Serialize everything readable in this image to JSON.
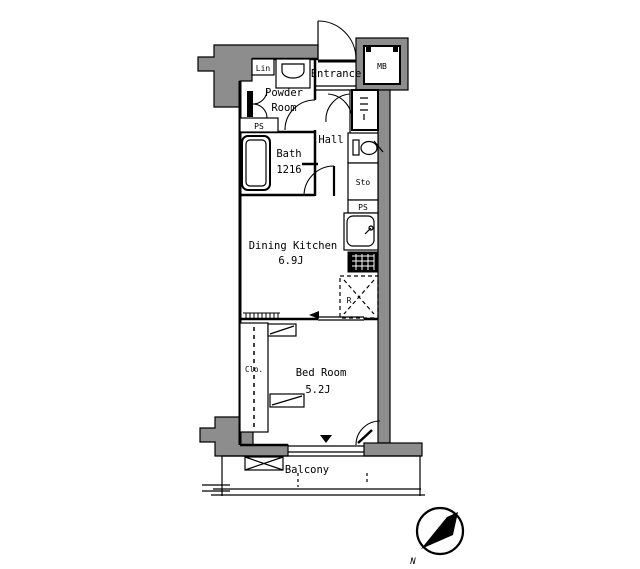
{
  "floorplan": {
    "rooms": {
      "entrance": {
        "label": "Entrance"
      },
      "meter_box": {
        "label": "MB"
      },
      "linen": {
        "label": "Lin"
      },
      "powder_room": {
        "label_line1": "Powder",
        "label_line2": "Room"
      },
      "pipe_space_upper": {
        "label": "PS"
      },
      "bath": {
        "label": "Bath",
        "size": "1216"
      },
      "hall": {
        "label": "Hall"
      },
      "storage": {
        "label": "Sto"
      },
      "pipe_space_lower": {
        "label": "PS"
      },
      "refrigerator_space": {
        "label": "R"
      },
      "dining_kitchen": {
        "label": "Dining Kitchen",
        "size": "6.9J"
      },
      "bed_room": {
        "label": "Bed Room",
        "size": "5.2J"
      },
      "closet": {
        "label": "Clo."
      },
      "balcony": {
        "label": "Balcony"
      }
    },
    "compass": {
      "north_label": "N"
    },
    "colors": {
      "wall_fill": "#8d8d8d",
      "line": "#000000",
      "background": "#ffffff"
    }
  }
}
